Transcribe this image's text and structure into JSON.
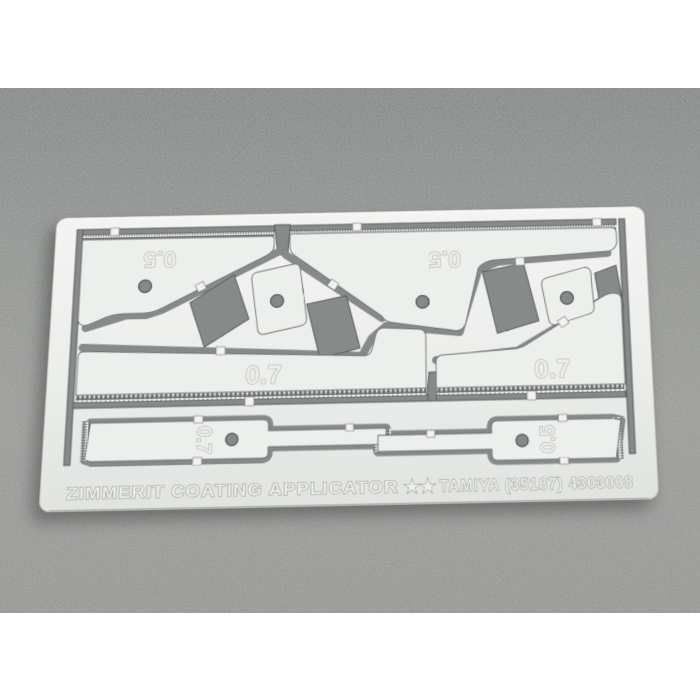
{
  "photo": {
    "description": "Product photo of a photo-etched metal sheet (Zimmerit coating applicator tool set) lying on a gray textured background",
    "background_color": "#8a8c89",
    "plate_color": "#edefec",
    "cutout_color": "#868a88"
  },
  "plate": {
    "labels": {
      "top_left": "0.5",
      "top_right": "0.5",
      "mid_left": "0.7",
      "mid_right": "0.7",
      "strip_left": "0.7",
      "strip_right": "0.5"
    },
    "engraving": {
      "product_name": "ZIMMERIT COATING APPLICATOR",
      "brand_line": "TAMIYA (35187) 4303008",
      "logo_glyph": "★★"
    }
  }
}
